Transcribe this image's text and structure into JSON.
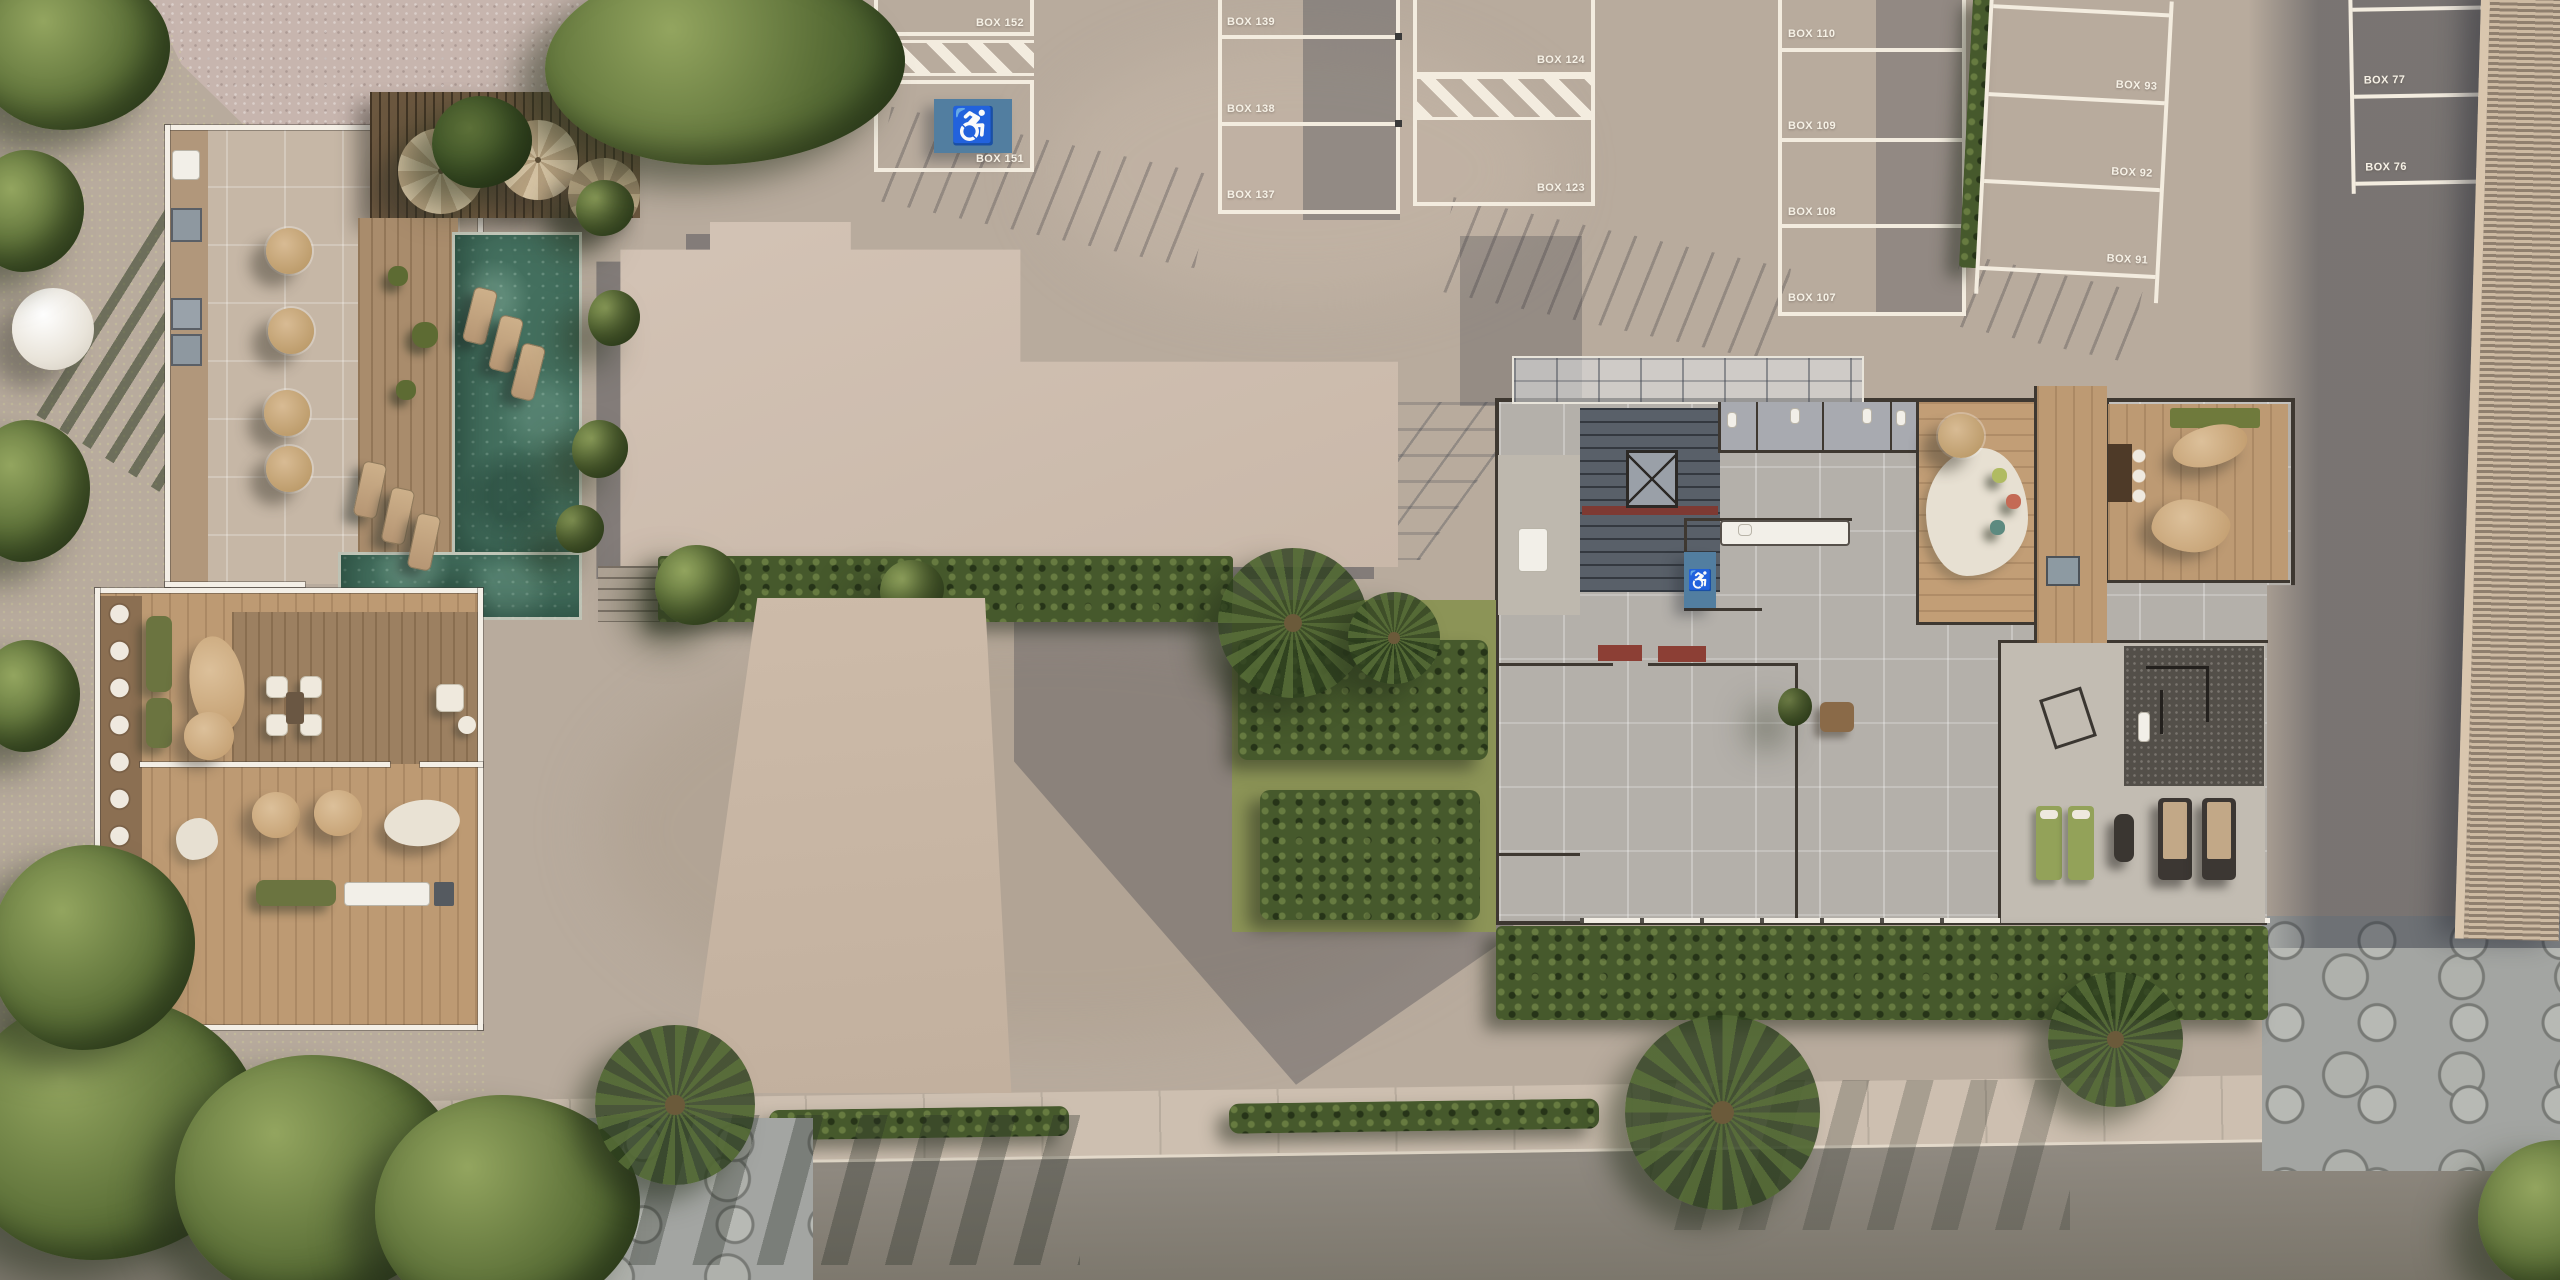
{
  "parking": {
    "boxes": [
      {
        "id": "box-152",
        "label": "BOX 152"
      },
      {
        "id": "box-151",
        "label": "BOX 151",
        "accessible": true
      },
      {
        "id": "box-139",
        "label": "BOX 139"
      },
      {
        "id": "box-138",
        "label": "BOX 138"
      },
      {
        "id": "box-137",
        "label": "BOX 137"
      },
      {
        "id": "box-124",
        "label": "BOX 124"
      },
      {
        "id": "box-123",
        "label": "BOX 123"
      },
      {
        "id": "box-110",
        "label": "BOX 110"
      },
      {
        "id": "box-109",
        "label": "BOX 109"
      },
      {
        "id": "box-108",
        "label": "BOX 108"
      },
      {
        "id": "box-107",
        "label": "BOX 107"
      },
      {
        "id": "box-93",
        "label": "BOX 93"
      },
      {
        "id": "box-92",
        "label": "BOX 92"
      },
      {
        "id": "box-91",
        "label": "BOX 91"
      },
      {
        "id": "box-77",
        "label": "BOX 77"
      },
      {
        "id": "box-76",
        "label": "BOX 76"
      }
    ]
  },
  "icons": {
    "accessible": "♿"
  },
  "palette": {
    "concrete": "#b8ab9d",
    "asphalt": "#7d786f",
    "grass": "#94a05c",
    "pool_water": "#44705f",
    "roof_beige": "#cfbfb1",
    "wood_deck": "#a9906e",
    "accessible_blue": "#527ea0",
    "stall_line": "#f3ecdf",
    "hedge_green": "#46592c",
    "shadow": "#2f3442"
  }
}
